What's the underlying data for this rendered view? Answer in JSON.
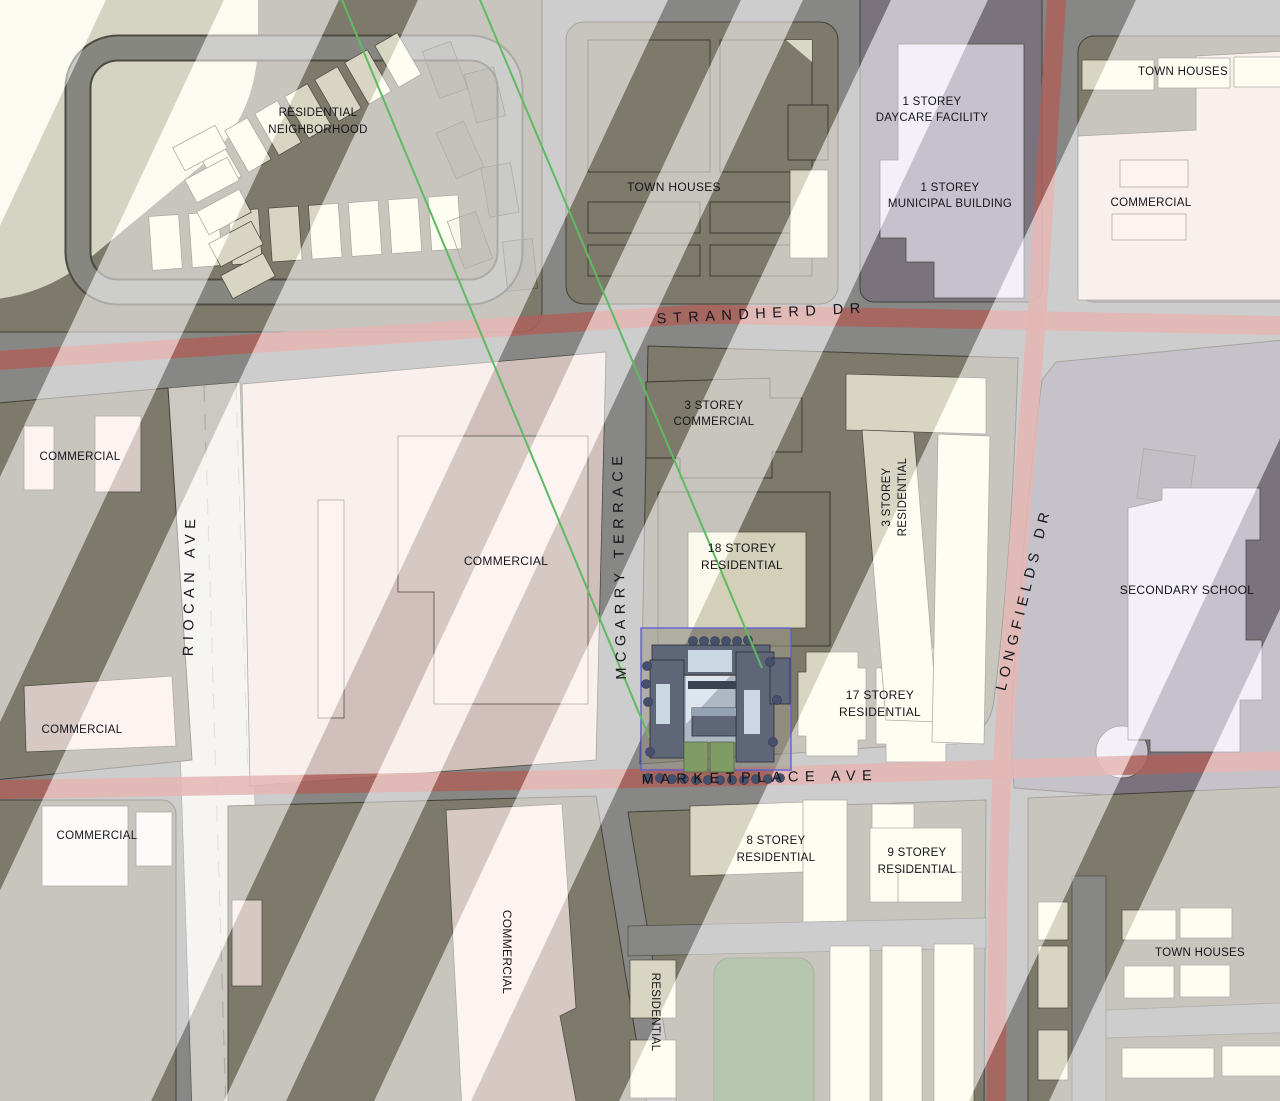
{
  "canvas": {
    "width": 1280,
    "height": 1101
  },
  "streets": {
    "strandherd": "STRANDHERD DR",
    "marketplace": "MARKETPLACE AVE",
    "riocan": "RIOCAN AVE",
    "mcgarry": "MCGARRY TERRACE",
    "longfields": "LONGFIELDS DR"
  },
  "areas": {
    "residential_neighborhood": {
      "line1": "RESIDENTIAL",
      "line2": "NEIGHBORHOOD"
    },
    "town_houses_top": "TOWN HOUSES",
    "daycare": {
      "line1": "1 STOREY",
      "line2": "DAYCARE FACILITY"
    },
    "municipal": {
      "line1": "1 STOREY",
      "line2": "MUNICIPAL BUILDING"
    },
    "town_houses_ne": "TOWN HOUSES",
    "commercial_ne": "COMMERCIAL",
    "commercial_west_upper": "COMMERCIAL",
    "commercial_west_lower": "COMMERCIAL",
    "commercial_center": "COMMERCIAL",
    "commercial_3storey": {
      "line1": "3 STOREY",
      "line2": "COMMERCIAL"
    },
    "residential_18storey": {
      "line1": "18 STOREY",
      "line2": "RESIDENTIAL"
    },
    "residential_3storey": {
      "line1": "3 STOREY",
      "line2": "RESIDENTIAL"
    },
    "residential_17storey": {
      "line1": "17 STOREY",
      "line2": "RESIDENTIAL"
    },
    "secondary_school": "SECONDARY SCHOOL",
    "residential_8storey": {
      "line1": "8 STOREY",
      "line2": "RESIDENTIAL"
    },
    "residential_9storey": {
      "line1": "9 STOREY",
      "line2": "RESIDENTIAL"
    },
    "commercial_sw": "COMMERCIAL",
    "commercial_south": "COMMERCIAL",
    "residential_south": "RESIDENTIAL",
    "town_houses_se": "TOWN HOUSES"
  },
  "colors": {
    "road": "#9B9B9B",
    "block": "#8F8B7D",
    "block_purple": "#8C8492",
    "road_red": "#C96F6A",
    "cream": "#FCFAE4",
    "cream_patch": "#F5F2D8",
    "pink_building": "#FAE9E5",
    "pink_lot": "#F2DEDA",
    "lavender": "#E7E0F2",
    "park_green": "#6E8C5C",
    "site_outline_blue": "#5B5BD8",
    "site_building": "#5E6678",
    "site_roof_light": "#CBD8E4",
    "sight_line_green": "#5FBA62",
    "label_ink": "#15151A",
    "riocan_white": "#ECEAE4"
  }
}
